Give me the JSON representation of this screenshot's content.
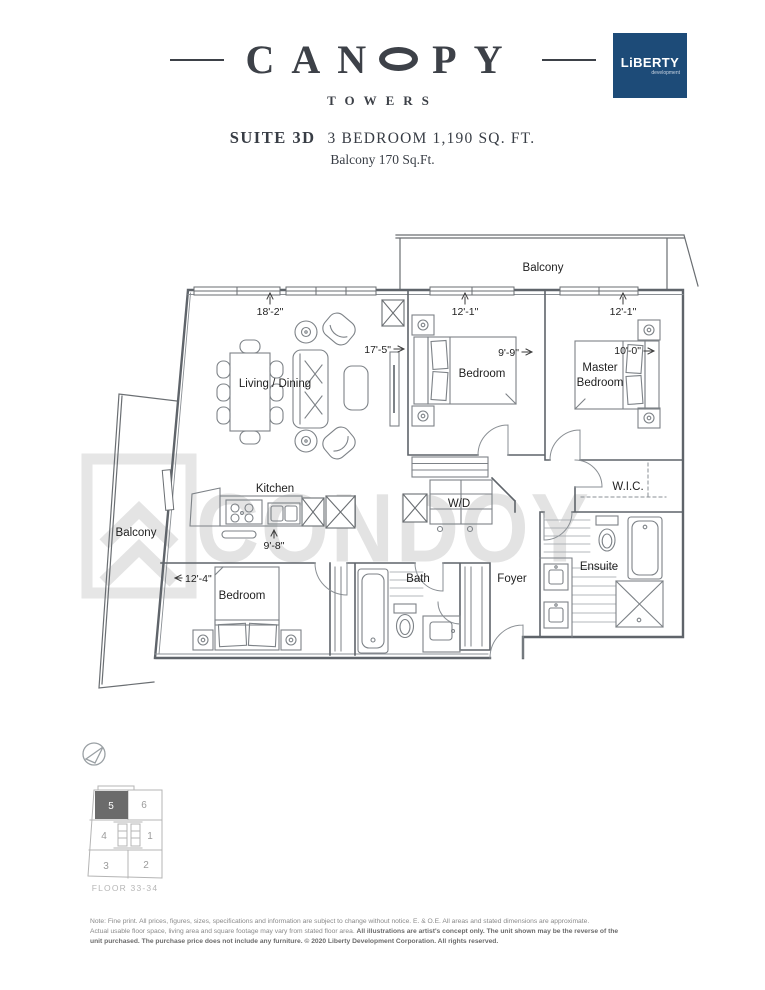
{
  "header": {
    "brand_left": "CAN",
    "brand_right": "PY",
    "subtitle": "TOWERS",
    "logo_name": "LiBERTY",
    "logo_sub": "development",
    "suite_label": "SUITE 3D",
    "suite_info": "3 BEDROOM 1,190 SQ. FT.",
    "balcony_info": "Balcony 170 Sq.Ft."
  },
  "plan": {
    "watermark": "CONDOY",
    "labels": {
      "balcony_top": "Balcony",
      "balcony_left": "Balcony",
      "living": "Living / Dining",
      "kitchen": "Kitchen",
      "bedroom2": "Bedroom",
      "master_line1": "Master",
      "master_line2": "Bedroom",
      "bedroom3": "Bedroom",
      "bath": "Bath",
      "ensuite": "Ensuite",
      "wic": "W.I.C.",
      "foyer": "Foyer",
      "wd": "W/D"
    },
    "dims": {
      "living_w": "18'-2\"",
      "living_d": "17'-5\"",
      "kitchen_w": "9'-8\"",
      "bedroom2_w": "12'-1\"",
      "bedroom2_d": "9'-9\"",
      "master_w": "12'-1\"",
      "master_d": "10'-0\"",
      "bedroom3_w": "12'-4\""
    }
  },
  "keyplan": {
    "floor_label": "FLOOR 33-34",
    "highlighted_unit": "5",
    "units": {
      "u1": "1",
      "u2": "2",
      "u3": "3",
      "u4": "4",
      "u5": "5",
      "u6": "6"
    }
  },
  "footnote": {
    "line1": "Note: Fine print. All prices, figures, sizes, specifications and information are subject to change without notice. E. & O.E. All areas and stated dimensions are approximate.",
    "line2_regular": "Actual usable floor space, living area and square footage may vary from stated floor area. ",
    "line2_bold": "All illustrations are artist's concept only. The unit shown may be the reverse of the",
    "line3_bold": "unit purchased. The purchase price does not include any furniture. © 2020 Liberty Development Corporation. All rights reserved."
  },
  "colors": {
    "logo_navy": "#1d4b78",
    "keyplan_highlight": "#6b6b6b"
  }
}
